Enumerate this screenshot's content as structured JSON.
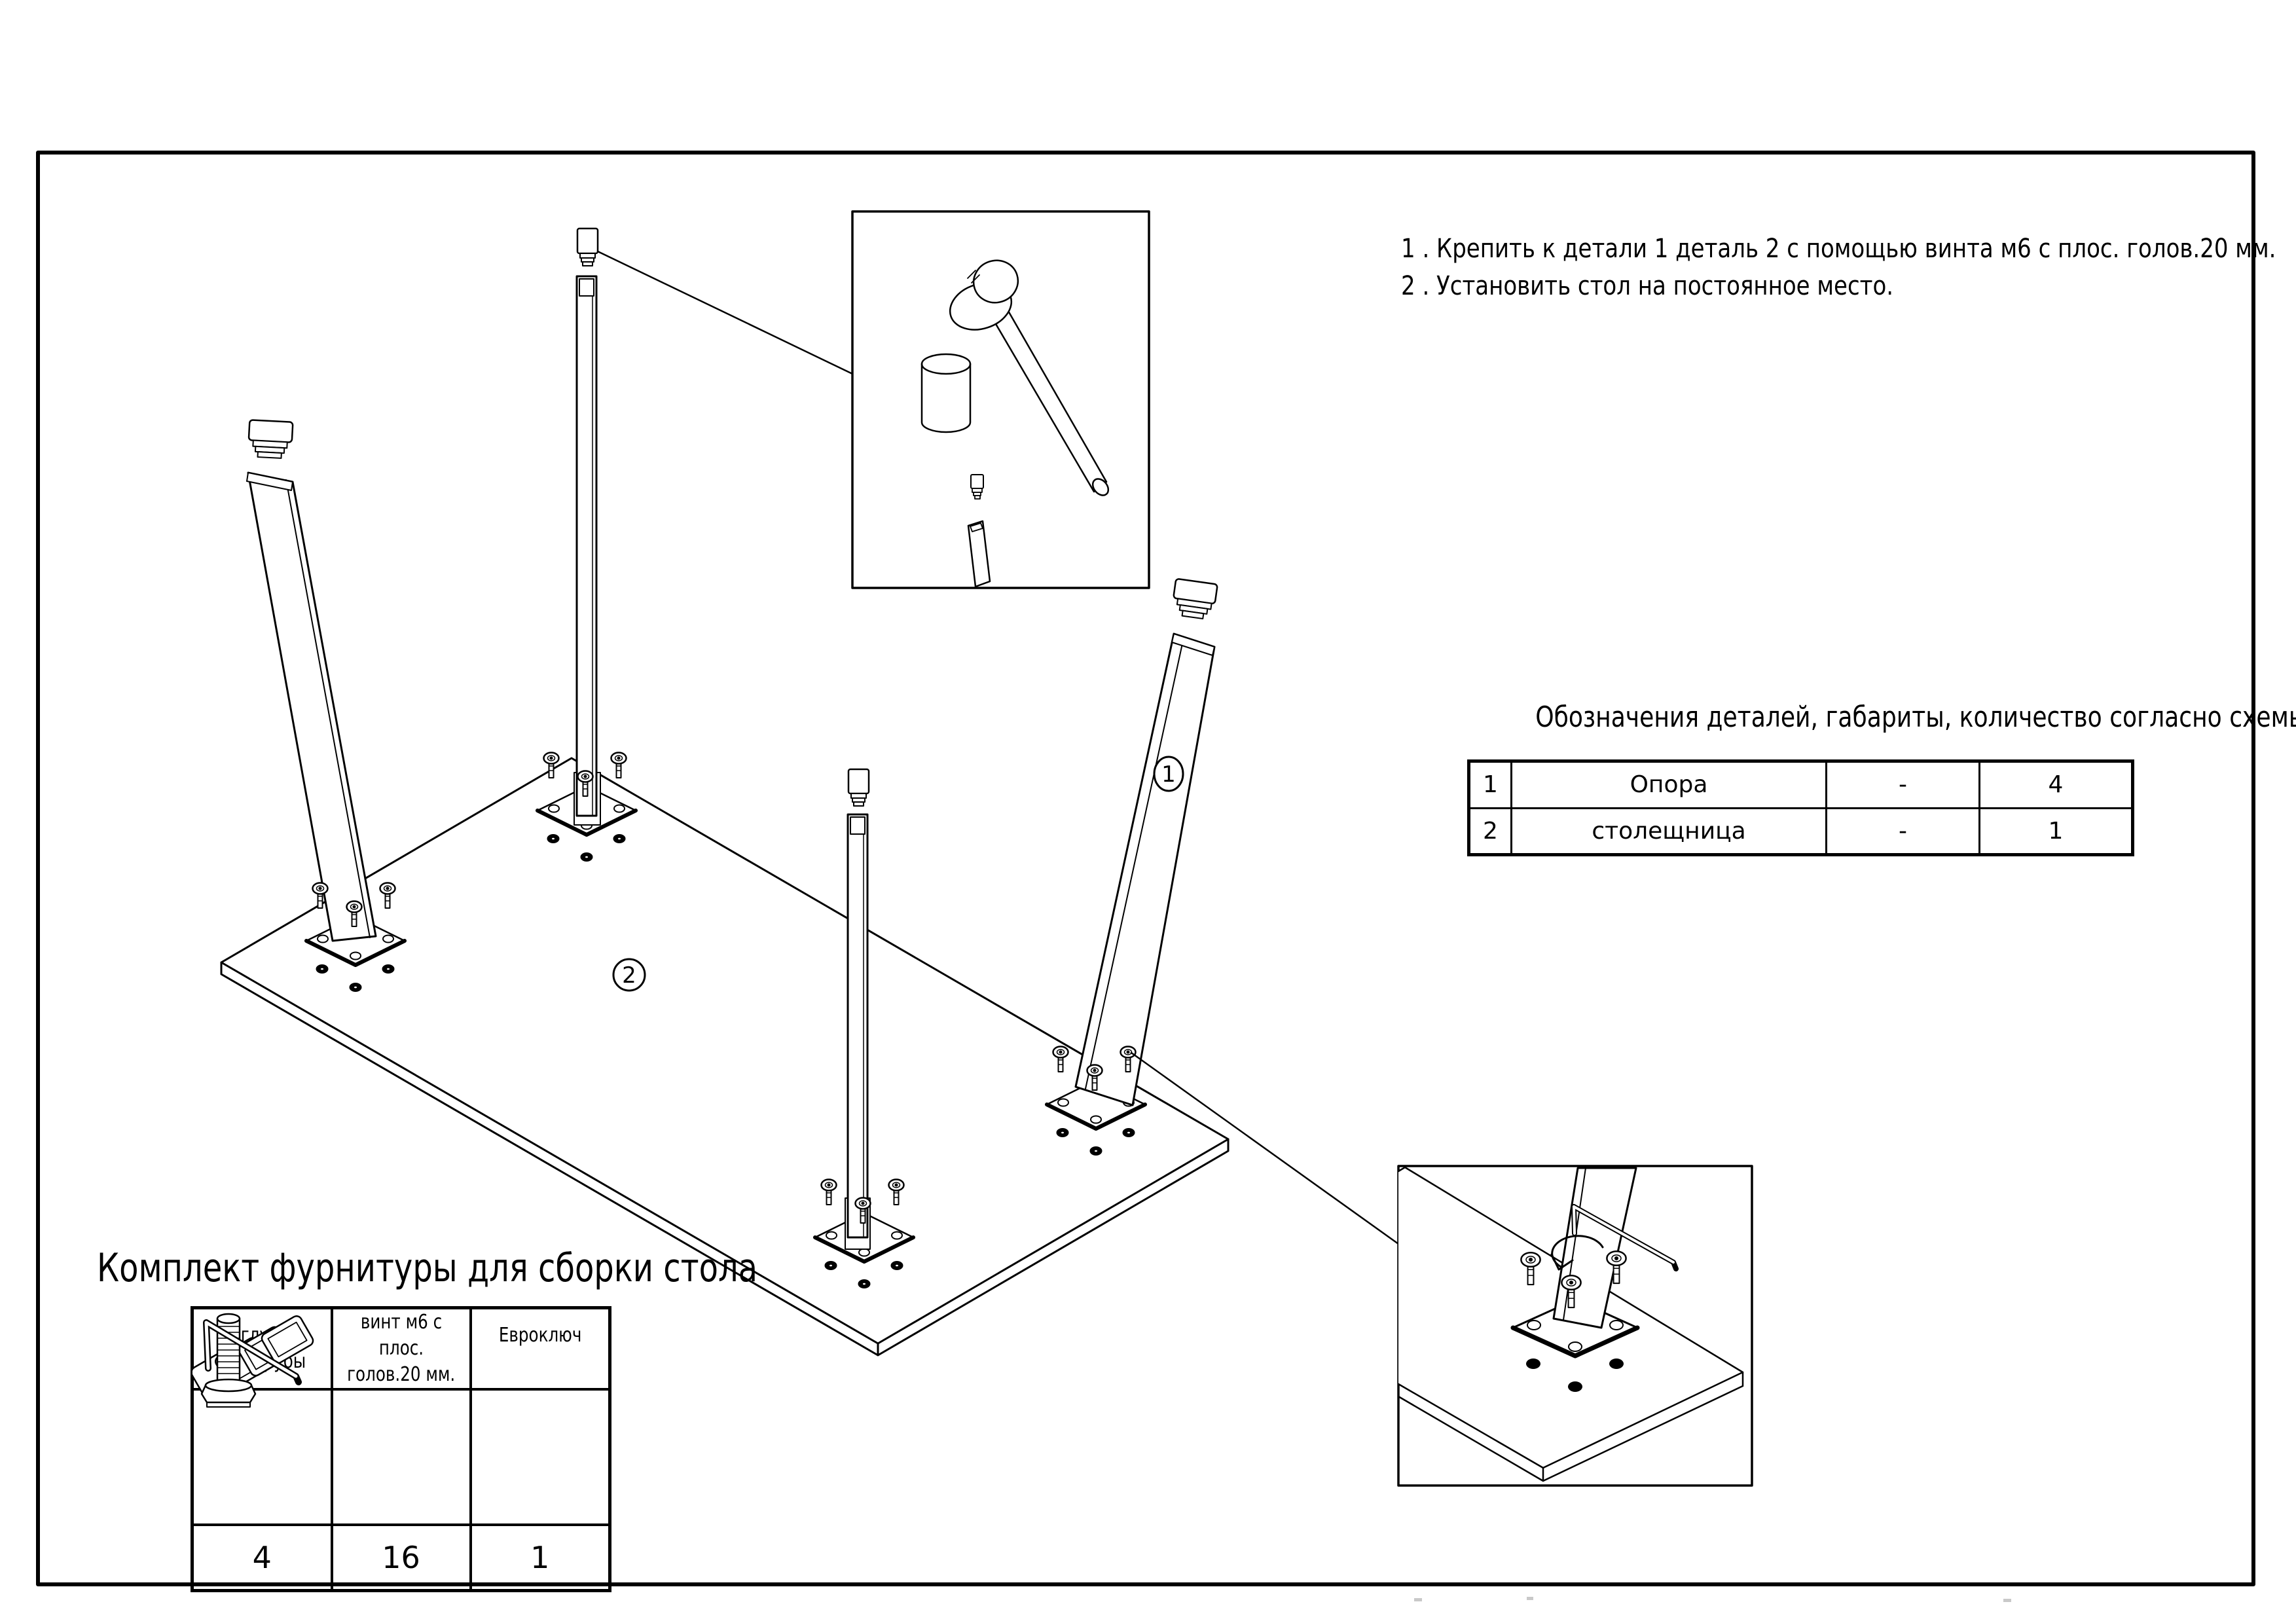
{
  "instructions": {
    "line1": "1 . Крепить к детали 1 деталь 2 с помощью винта м6 с плос. голов.20 мм.",
    "line2": "2 . Установить стол на постоянное место."
  },
  "parts_table": {
    "title": "Обозначения деталей, габариты, количество согласно схемы сборки",
    "rows": [
      {
        "num": "1",
        "name": "Опора",
        "size": "-",
        "qty": "4"
      },
      {
        "num": "2",
        "name": "столещница",
        "size": "-",
        "qty": "1"
      }
    ]
  },
  "hardware_table": {
    "title": "Комплект фурнитуры для сборки стола",
    "columns": [
      {
        "label_line1": "Заглушка",
        "label_line2": "для трубы",
        "icon": "tube-caps-icon",
        "qty": "4"
      },
      {
        "label_line1": "винт м6 с плос.",
        "label_line2": "голов.20 мм.",
        "icon": "screw-icon",
        "qty": "16"
      },
      {
        "label_line1": "Евроключ",
        "label_line2": "",
        "icon": "hex-key-icon",
        "qty": "1"
      }
    ]
  },
  "diagram": {
    "callout_leg": "1",
    "callout_top": "2"
  },
  "colors": {
    "ink": "#000000",
    "paper": "#ffffff"
  }
}
